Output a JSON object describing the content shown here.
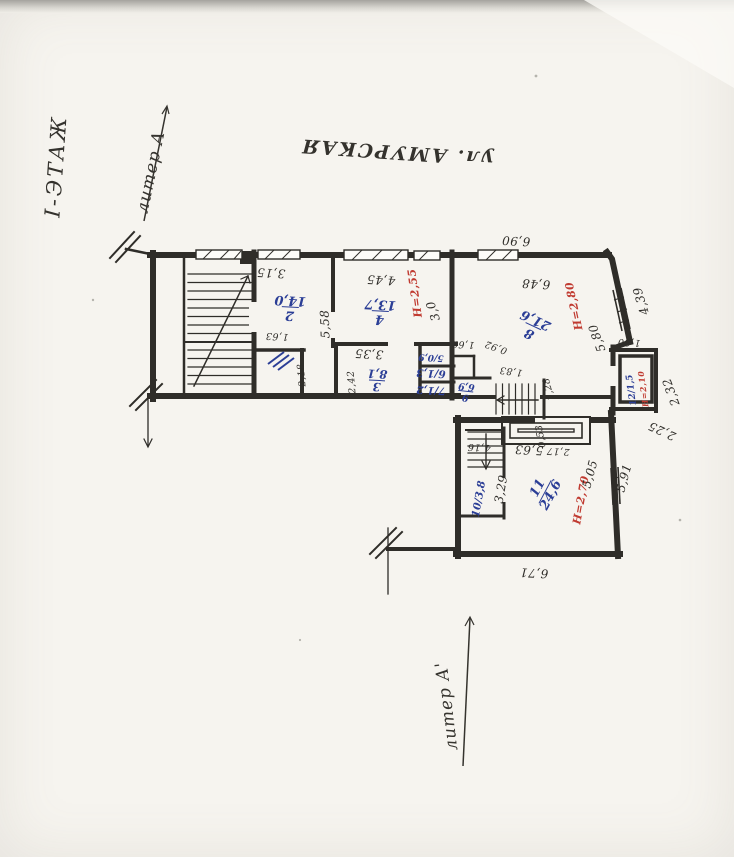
{
  "annotations": {
    "floor": "І-ЭТАЖ",
    "street": "ул. АМУРСКАЯ",
    "liter_top": "литер А",
    "liter_bottom": "литер А'"
  },
  "colors": {
    "ink": "#2f2d29",
    "blue": "#2b3e96",
    "red": "#c03a30"
  },
  "rooms": {
    "r2": {
      "num": "2",
      "area": "14,0"
    },
    "r3": {
      "num": "3",
      "area": "8,1"
    },
    "r4": {
      "num": "4",
      "area": "13,7"
    },
    "r5": {
      "label": "5/0,9"
    },
    "r6": {
      "label": "6/1,3"
    },
    "r7": {
      "label": "7/1,2"
    },
    "r8": {
      "num": "8",
      "area": "21,6"
    },
    "r9": {
      "num": "9",
      "area": "6,9"
    },
    "r10": {
      "label": "10/3,8"
    },
    "r11": {
      "num": "11",
      "area": "24,6"
    },
    "r12": {
      "label": "12/1,5"
    }
  },
  "heights": {
    "r4": "Н=2,55",
    "r8": "Н=2,80",
    "r11": "Н=2,70",
    "r12": "Н=2,10"
  },
  "dims": {
    "top_width": "6,90",
    "room2_w": "3,15",
    "room4_w": "4,45",
    "room8_w": "6,48",
    "slant": "4,39",
    "room8_right": "5,80",
    "porch_top": "1,80",
    "porch_right": "2,32",
    "porch_bottom": "2,25",
    "room2_h": "5,58",
    "room4_right": "3,0",
    "closet_w": "1,63",
    "closet_h": "2,18",
    "room3_h": "2,42",
    "room3_w": "3,35",
    "nook_left": "1,69",
    "nook_a": "0,92",
    "nook_b": "1,83",
    "nook_c": "1,28",
    "low_a": "4,16",
    "low_b": "5,63",
    "low_c": "2,17",
    "low_d": "0,53",
    "room11_left": "3,29",
    "room11_right": "5,05",
    "low_right": "5,91",
    "bottom_width": "6,71"
  }
}
